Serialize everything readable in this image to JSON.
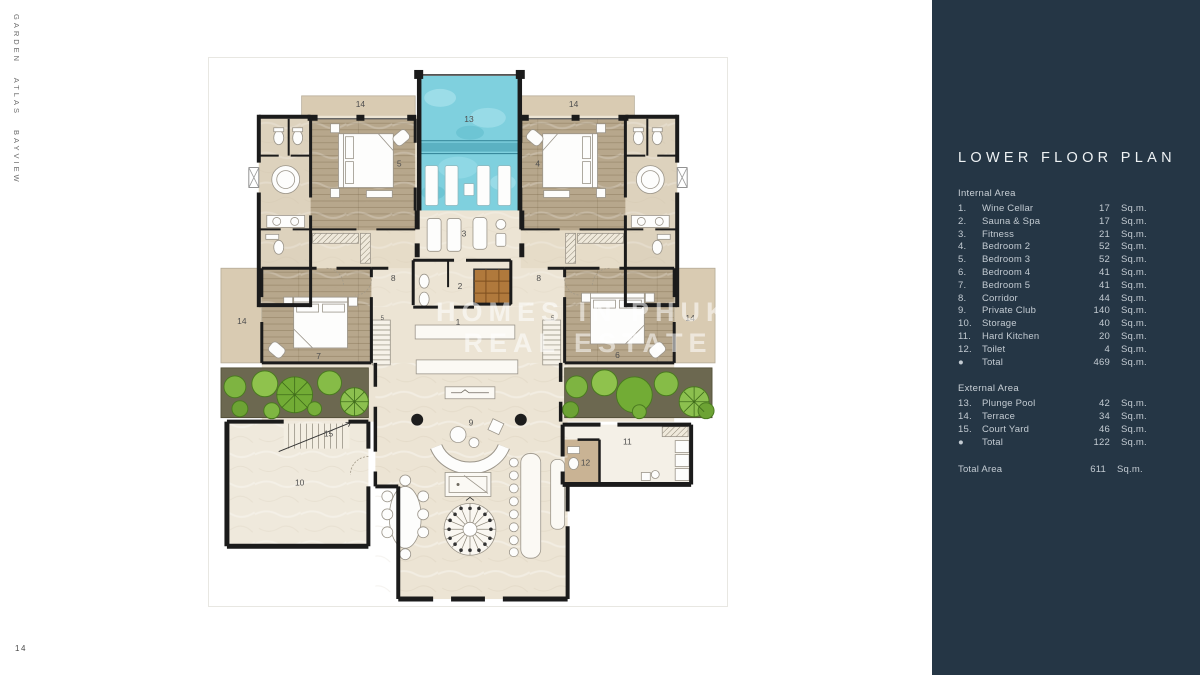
{
  "page": {
    "number": "14",
    "brand_vertical": "GARDEN ATLAS BAYVIEW"
  },
  "watermark": {
    "line1": "HOMES IN PHUKET",
    "line2": "REAL ESTATE"
  },
  "sidebar": {
    "title": "LOWER FLOOR PLAN",
    "internal": {
      "heading": "Internal Area",
      "items": [
        {
          "num": "1.",
          "label": "Wine Cellar",
          "value": "17",
          "unit": "Sq.m."
        },
        {
          "num": "2.",
          "label": "Sauna & Spa",
          "value": "17",
          "unit": "Sq.m."
        },
        {
          "num": "3.",
          "label": "Fitness",
          "value": "21",
          "unit": "Sq.m."
        },
        {
          "num": "4.",
          "label": "Bedroom 2",
          "value": "52",
          "unit": "Sq.m."
        },
        {
          "num": "5.",
          "label": "Bedroom 3",
          "value": "52",
          "unit": "Sq.m."
        },
        {
          "num": "6.",
          "label": "Bedroom 4",
          "value": "41",
          "unit": "Sq.m."
        },
        {
          "num": "7.",
          "label": "Bedroom 5",
          "value": "41",
          "unit": "Sq.m."
        },
        {
          "num": "8.",
          "label": "Corridor",
          "value": "44",
          "unit": "Sq.m."
        },
        {
          "num": "9.",
          "label": "Private Club",
          "value": "140",
          "unit": "Sq.m."
        },
        {
          "num": "10.",
          "label": "Storage",
          "value": "40",
          "unit": "Sq.m."
        },
        {
          "num": "11.",
          "label": "Hard Kitchen",
          "value": "20",
          "unit": "Sq.m."
        },
        {
          "num": "12.",
          "label": "Toilet",
          "value": "4",
          "unit": "Sq.m."
        },
        {
          "num": "●",
          "label": "Total",
          "value": "469",
          "unit": "Sq.m."
        }
      ]
    },
    "external": {
      "heading": "External Area",
      "items": [
        {
          "num": "13.",
          "label": "Plunge Pool",
          "value": "42",
          "unit": "Sq.m."
        },
        {
          "num": "14.",
          "label": "Terrace",
          "value": "34",
          "unit": "Sq.m."
        },
        {
          "num": "15.",
          "label": "Court Yard",
          "value": "46",
          "unit": "Sq.m."
        },
        {
          "num": "●",
          "label": "Total",
          "value": "122",
          "unit": "Sq.m."
        }
      ]
    },
    "total_area": {
      "label": "Total Area",
      "value": "611",
      "unit": "Sq.m."
    }
  },
  "plan_labels": [
    {
      "t": "14",
      "x": 152,
      "y": 49
    },
    {
      "t": "13",
      "x": 261,
      "y": 64
    },
    {
      "t": "14",
      "x": 366,
      "y": 49
    },
    {
      "t": "5",
      "x": 191,
      "y": 109
    },
    {
      "t": "4",
      "x": 330,
      "y": 109
    },
    {
      "t": "3",
      "x": 256,
      "y": 179
    },
    {
      "t": "8",
      "x": 185,
      "y": 224
    },
    {
      "t": "8",
      "x": 331,
      "y": 224
    },
    {
      "t": "2",
      "x": 252,
      "y": 232
    },
    {
      "t": "1",
      "x": 250,
      "y": 268
    },
    {
      "t": "14",
      "x": 33,
      "y": 267
    },
    {
      "t": "14",
      "x": 483,
      "y": 264
    },
    {
      "t": "7",
      "x": 110,
      "y": 302
    },
    {
      "t": "6",
      "x": 410,
      "y": 301
    },
    {
      "t": "5",
      "x": 174,
      "y": 263,
      "s": 6
    },
    {
      "t": "5",
      "x": 345,
      "y": 263,
      "s": 6
    },
    {
      "t": "9",
      "x": 263,
      "y": 369
    },
    {
      "t": "15",
      "x": 120,
      "y": 380
    },
    {
      "t": "10",
      "x": 91,
      "y": 429
    },
    {
      "t": "11",
      "x": 420,
      "y": 388
    },
    {
      "t": "12",
      "x": 378,
      "y": 409
    }
  ]
}
